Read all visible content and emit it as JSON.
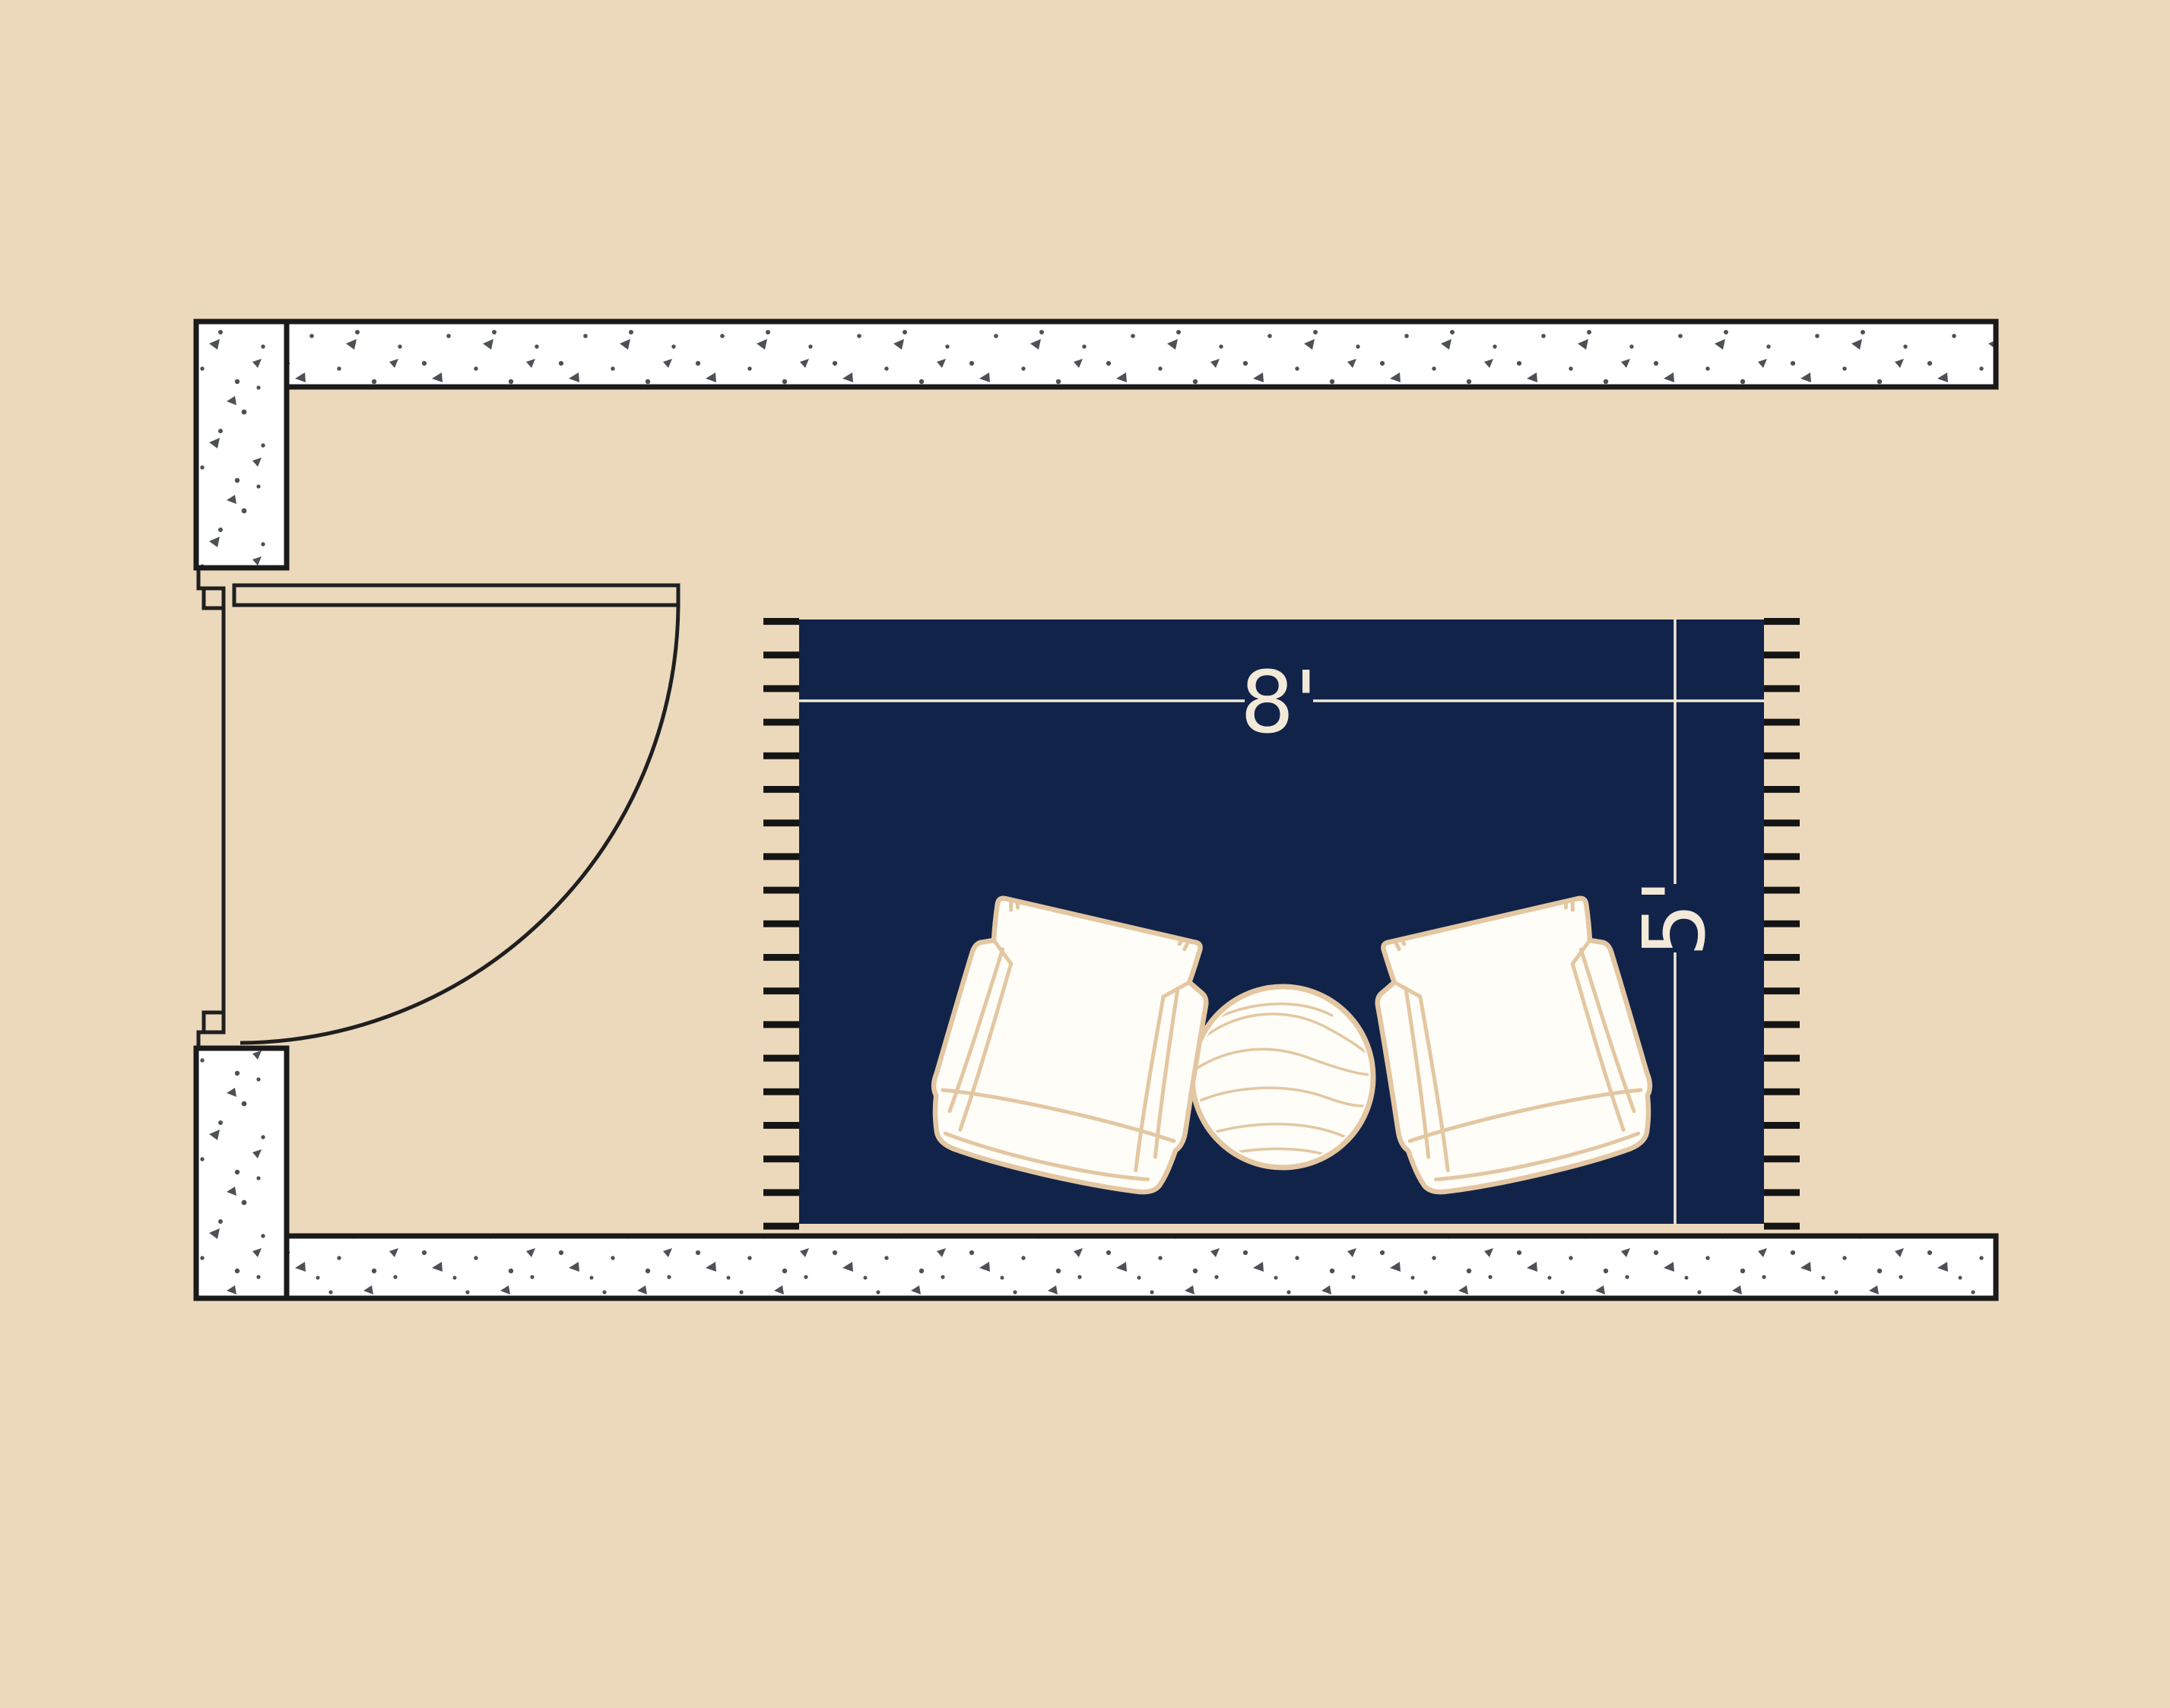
{
  "rug": {
    "width_label": "8'",
    "length_label": "5'"
  },
  "scene": {
    "background_color": "#ecd9bc",
    "rug_color": "#112348",
    "dimension_color": "#f2e9d8",
    "wall_fill_color": "#ffffff",
    "wall_outline_color": "#1a1a1a",
    "wall_speckle_color": "#4d5156",
    "fringe_color": "#141414",
    "furniture_outline_color": "#e3c7a2",
    "furniture_fill_color": "#fffdf8"
  },
  "objects": {
    "door": "swing-door",
    "armchair_left": "armchair",
    "armchair_right": "armchair",
    "side_table": "round-side-table"
  }
}
